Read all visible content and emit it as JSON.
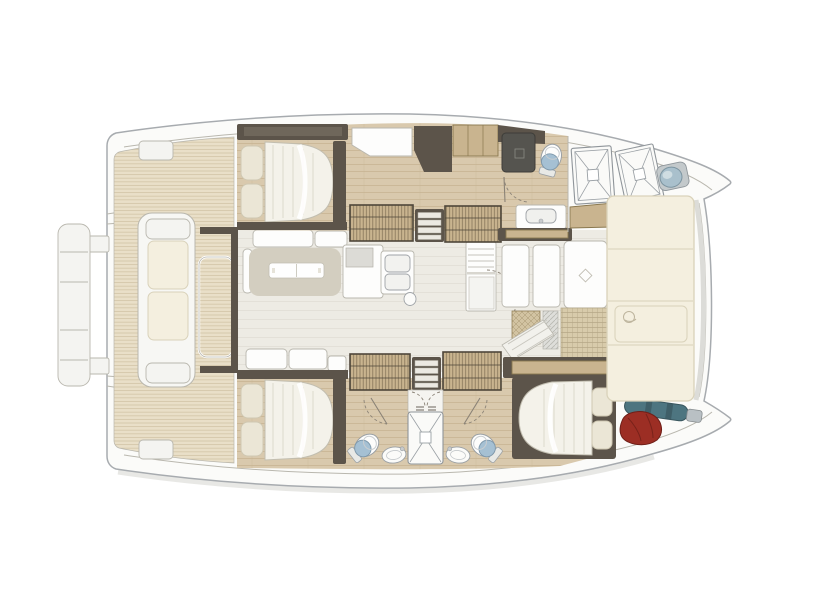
{
  "meta": {
    "title": "Catamaran yacht deck floor plan — top-down view, bow to the right",
    "view": "top-down",
    "orientation": "bow-right"
  },
  "colors": {
    "hullFill": "#fbfbf9",
    "hullStroke": "#a7abaf",
    "grayLine": "#b9b7ae",
    "shadow": "#e2e2df",
    "teakBase": "#e9dfc8",
    "teakLine": "#cfc0a1",
    "woodBase": "#d9c9ad",
    "woodLine": "#c7b391",
    "saloonBase": "#edebe4",
    "saloonLine": "#e0ddd5",
    "dark": "#5c544a",
    "darkLight": "#7a7164",
    "tan": "#c9b48f",
    "tanDark": "#8a784f",
    "louver": "#6e5f45",
    "white": "#fdfdfc",
    "offWhite": "#f4f4f1",
    "mattress": "#f4f2ea",
    "mattressStripe": "#e3e0d5",
    "mattressEdge": "#c2beb0",
    "pillow": "#ebe6d6",
    "pillowEdge": "#cfc8b2",
    "cushion": "#f4efdf",
    "cushionEdge": "#d9d2ba",
    "lounge": "#d3cec0",
    "toiletBlue": "#a5c0d3",
    "toiletEdge": "#7e98ab",
    "showerDark": "#55544f",
    "red": "#9c2e24",
    "redDark": "#6f1f18",
    "teal": "#4d7580",
    "tealDark": "#39565e",
    "steel": "#b9c0c4",
    "cross": "#d2c3a2",
    "crossLine": "#a59470",
    "tramp": "#d8cbab",
    "trampLine": "#b3a485"
  },
  "layout": {
    "stern": {
      "swim_platform_segments": 4,
      "transom_lockers": 2
    },
    "aft_cockpit": {
      "deck": "teak",
      "items": [
        "bench-seat-with-cushions",
        "cockpit-table"
      ]
    },
    "saloon": {
      "items": [
        "l-settee",
        "lounge-pad",
        "serving-tray-table",
        "aft-settee",
        "galley-counter",
        "cooktop",
        "double-sink",
        "faucet",
        "fridge-shelf-cabinet",
        "forward-door-panels",
        "steps-down"
      ]
    },
    "port_hull": {
      "cabins": [
        {
          "name": "aft-double-cabin",
          "bed": "double",
          "pillows": 2
        }
      ],
      "bathroom": {
        "shower": 1,
        "toilet": 1,
        "sink": 1
      },
      "wardrobes": 2,
      "companionway_steps": 1,
      "vanity_desk": 1,
      "deck_hatches": 2,
      "bow_winch": 1
    },
    "starboard_hull": {
      "cabins": [
        {
          "name": "aft-double-cabin",
          "bed": "double",
          "pillows": 2
        },
        {
          "name": "forward-double-cabin",
          "bed": "double",
          "pillows": 2
        }
      ],
      "bathrooms": 2,
      "central_shower": 1,
      "wardrobes": 2,
      "companionway_steps": 1,
      "bow_gear": [
        "red-sail-bag",
        "teal-furled-gear"
      ]
    },
    "foredeck": {
      "sunpad_panels": 4,
      "trampoline_sections": 2,
      "access_mats": 2
    }
  }
}
